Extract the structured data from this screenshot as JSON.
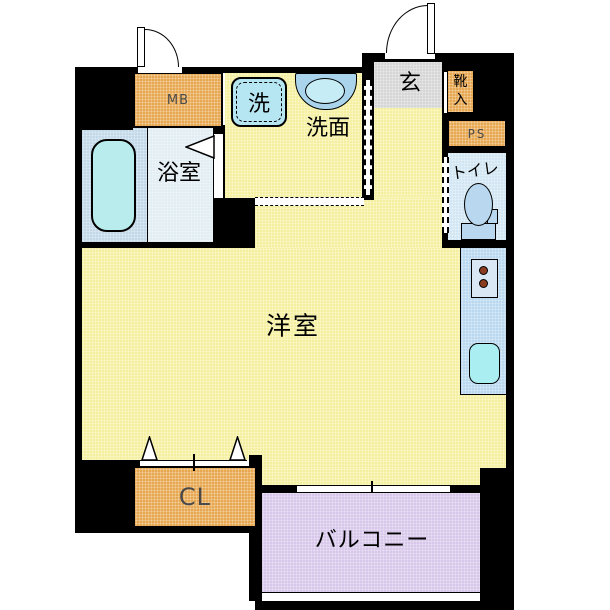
{
  "rooms": {
    "mb": {
      "label": "MB"
    },
    "bathroom": {
      "label": "浴室"
    },
    "washer": {
      "label": "洗"
    },
    "washroom": {
      "label": "洗面"
    },
    "entrance": {
      "label": "玄"
    },
    "shoe_box": {
      "label": "靴入"
    },
    "ps": {
      "label": "PS"
    },
    "toilet": {
      "label": "トイレ"
    },
    "main_room": {
      "label": "洋室"
    },
    "closet": {
      "label": "CL"
    },
    "balcony": {
      "label": "バルコニー"
    }
  },
  "colors": {
    "wall": "#000000",
    "floor": "#f5f0a1",
    "orange": "#e8a751",
    "entrance": "#d6d6d6",
    "bath_left": "#c3d9ea",
    "bath_right": "#e2edf4",
    "tub": "#b9eded",
    "pad": "#b5e6f2",
    "basin": "#a9d4ec",
    "basin_inner": "#c6ecf6",
    "toilet_room": "#d2e7f3",
    "fixture": "#b9d7ee",
    "counter": "#bad8f0",
    "stove": "#d8e7f3",
    "burner": "#8a3c20",
    "sink": "#abeef2",
    "balcony": "#d7c7ea",
    "label_gray": "#4a4a4a"
  }
}
